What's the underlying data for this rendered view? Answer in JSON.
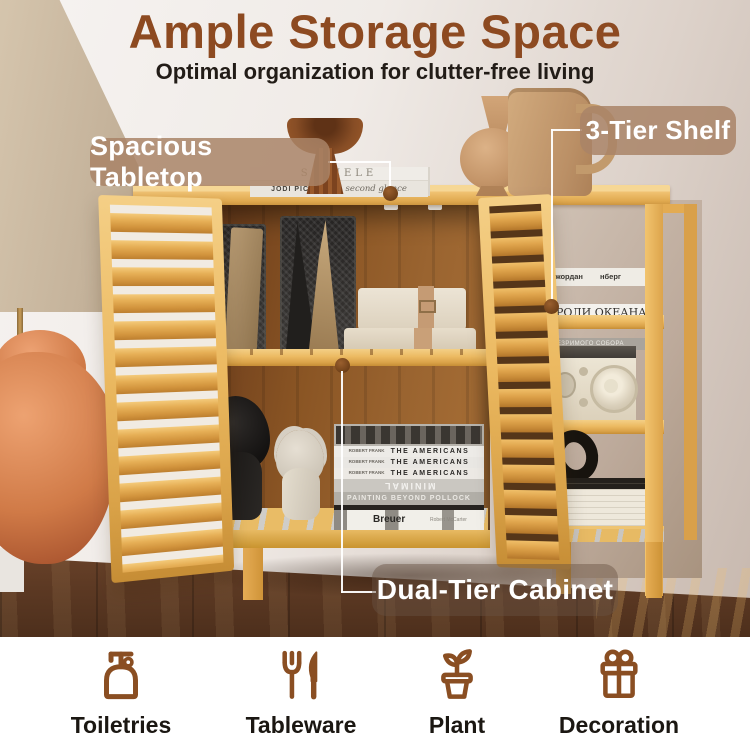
{
  "header": {
    "title": "Ample Storage Space",
    "subtitle": "Optimal organization for clutter-free living"
  },
  "callouts": {
    "tabletop": "Spacious Tabletop",
    "shelf": "3-Tier Shelf",
    "cabinet": "Dual-Tier Cabinet"
  },
  "features": [
    {
      "label": "Toiletries",
      "icon": "soap-dispenser-icon"
    },
    {
      "label": "Tableware",
      "icon": "fork-knife-icon"
    },
    {
      "label": "Plant",
      "icon": "potted-plant-icon"
    },
    {
      "label": "Decoration",
      "icon": "gift-box-icon"
    }
  ],
  "photo_text": {
    "tabletop_books": {
      "book1_title": "SCHIELE",
      "book2_author": "JODI PICOULT",
      "book2_title": "second glance"
    },
    "cabinet_books": {
      "americans_author": "ROBERT FRANK",
      "americans_title": "THE AMERICANS",
      "minimal_title": "MINIMAL",
      "pollock_title": "PAINTING BEYOND POLLOCK",
      "breuer_title": "Breuer",
      "breuer_author": "Robert McCarter"
    },
    "shelf_books": {
      "book1_left": "Джордан",
      "book1_right": "нберг",
      "book2_title": "РОЛИ ОКЕАНА",
      "book3_title": "НЕЗРИМОГО СОБОРА"
    }
  },
  "colors": {
    "title_brown": "#8D4A21",
    "icon_brown": "#8A4E22",
    "label_dark": "#1B1712",
    "callout_pill": "#A98467",
    "wood_light": "#ECBA62",
    "wood_floor": "#5D3A24"
  }
}
